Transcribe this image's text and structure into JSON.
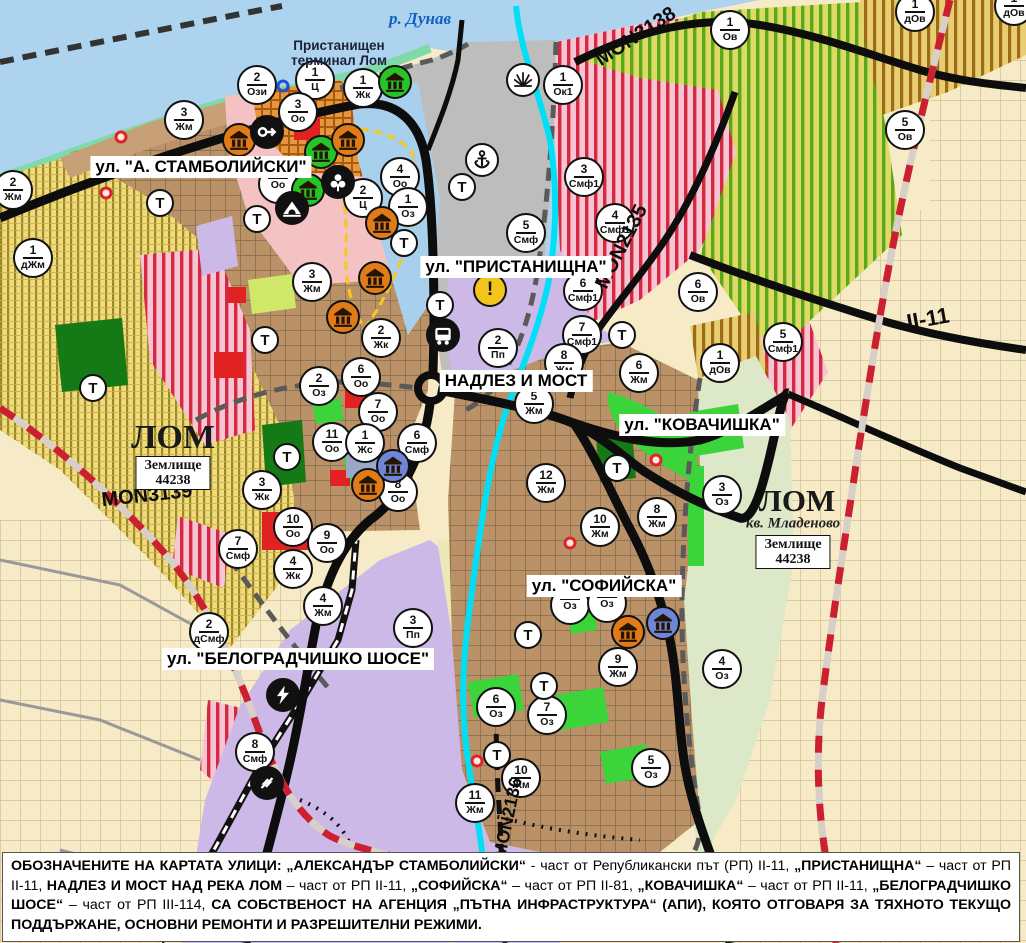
{
  "map": {
    "colors": {
      "water": "#aed3ee",
      "river_highlight": "#00dff5",
      "shore": "#7fd9a8",
      "port_gray": "#bdbdbd",
      "urban_brown": "#bb9268",
      "purple_zone": "#ccb9e8",
      "farm_yellow": "#f2dd7e",
      "mixed_pink": "#f6c4d2",
      "stripe_red": "#d42940",
      "vineyard_green": "#58a81c",
      "park_green": "#3bd43b",
      "dark_green": "#157a15",
      "road_black": "#0d0d0d",
      "boundary_red": "#cc2030",
      "warning_yellow": "#f2c41c",
      "monument_orange": "#e07b18",
      "monument_green": "#27c427",
      "monument_blue": "#6f86d6"
    },
    "place_labels": {
      "river": "р. Дунав",
      "port_terminal": "Пристанищен\nтерминал Лом",
      "city_west": "ЛОМ",
      "city_east": "ЛОМ",
      "quarter_east": "кв. Младеново",
      "land_box_line1": "Землище",
      "land_box_line2": "44238"
    },
    "street_labels": [
      {
        "x": 201,
        "y": 167,
        "text": "ул. \"А. СТАМБОЛИЙСКИ\""
      },
      {
        "x": 516,
        "y": 267,
        "text": "ул. \"ПРИСТАНИЩНА\""
      },
      {
        "x": 516,
        "y": 381,
        "text": "НАДЛЕЗ И МОСТ"
      },
      {
        "x": 702,
        "y": 425,
        "text": "ул. \"КОВАЧИШКА\""
      },
      {
        "x": 604,
        "y": 586,
        "text": "ул. \"СОФИЙСКА\""
      },
      {
        "x": 298,
        "y": 659,
        "text": "ул. \"БЕЛОГРАДЧИШКО ШОСЕ\""
      }
    ],
    "road_labels": [
      {
        "x": 147,
        "y": 496,
        "text": "MON3139",
        "rot": -6,
        "size": 20
      },
      {
        "x": 636,
        "y": 37,
        "text": "MON3138",
        "rot": -33,
        "size": 20
      },
      {
        "x": 622,
        "y": 247,
        "text": "MON2135",
        "rot": -63,
        "size": 20
      },
      {
        "x": 508,
        "y": 818,
        "text": "MON2136",
        "rot": -78,
        "size": 18
      },
      {
        "x": 928,
        "y": 319,
        "text": "II-11",
        "rot": -10,
        "size": 22
      }
    ],
    "area_boxes": [
      {
        "x": 173,
        "y": 473
      },
      {
        "x": 793,
        "y": 552
      }
    ],
    "zone_markers": [
      {
        "x": 315,
        "y": 80,
        "n": "1",
        "c": "Ц"
      },
      {
        "x": 363,
        "y": 88,
        "n": "1",
        "c": "Жк"
      },
      {
        "x": 257,
        "y": 85,
        "n": "2",
        "c": "Ози"
      },
      {
        "x": 298,
        "y": 112,
        "n": "3",
        "c": "Оо"
      },
      {
        "x": 184,
        "y": 120,
        "n": "3",
        "c": "Жм"
      },
      {
        "x": 13,
        "y": 190,
        "n": "2",
        "c": "Жм"
      },
      {
        "x": 33,
        "y": 258,
        "n": "1",
        "c": "дЖм"
      },
      {
        "x": 278,
        "y": 184,
        "n": "",
        "c": "Оо"
      },
      {
        "x": 400,
        "y": 177,
        "n": "4",
        "c": "Оо"
      },
      {
        "x": 363,
        "y": 198,
        "n": "2",
        "c": "Ц"
      },
      {
        "x": 408,
        "y": 207,
        "n": "1",
        "c": "Оз"
      },
      {
        "x": 563,
        "y": 85,
        "n": "1",
        "c": "Ок1"
      },
      {
        "x": 584,
        "y": 177,
        "n": "3",
        "c": "Смф1"
      },
      {
        "x": 526,
        "y": 233,
        "n": "5",
        "c": "Смф"
      },
      {
        "x": 615,
        "y": 223,
        "n": "4",
        "c": "Смф1"
      },
      {
        "x": 583,
        "y": 291,
        "n": "6",
        "c": "Смф1"
      },
      {
        "x": 698,
        "y": 292,
        "n": "6",
        "c": "Ов"
      },
      {
        "x": 720,
        "y": 363,
        "n": "1",
        "c": "дОв"
      },
      {
        "x": 783,
        "y": 342,
        "n": "5",
        "c": "Смф1"
      },
      {
        "x": 730,
        "y": 30,
        "n": "1",
        "c": "Ов"
      },
      {
        "x": 905,
        "y": 130,
        "n": "5",
        "c": "Ов"
      },
      {
        "x": 915,
        "y": 12,
        "n": "1",
        "c": "дОв"
      },
      {
        "x": 1014,
        "y": 6,
        "n": "1",
        "c": "дОв"
      },
      {
        "x": 312,
        "y": 282,
        "n": "3",
        "c": "Жм"
      },
      {
        "x": 381,
        "y": 338,
        "n": "2",
        "c": "Жк"
      },
      {
        "x": 361,
        "y": 377,
        "n": "6",
        "c": "Оо"
      },
      {
        "x": 319,
        "y": 386,
        "n": "2",
        "c": "Оз"
      },
      {
        "x": 378,
        "y": 412,
        "n": "7",
        "c": "Оо"
      },
      {
        "x": 332,
        "y": 442,
        "n": "11",
        "c": "Оо"
      },
      {
        "x": 365,
        "y": 443,
        "n": "1",
        "c": "Жс"
      },
      {
        "x": 417,
        "y": 443,
        "n": "6",
        "c": "Смф"
      },
      {
        "x": 398,
        "y": 492,
        "n": "8",
        "c": "Оо"
      },
      {
        "x": 498,
        "y": 348,
        "n": "2",
        "c": "Пп"
      },
      {
        "x": 582,
        "y": 335,
        "n": "7",
        "c": "Смф1"
      },
      {
        "x": 564,
        "y": 363,
        "n": "8",
        "c": "Жм"
      },
      {
        "x": 639,
        "y": 373,
        "n": "6",
        "c": "Жм"
      },
      {
        "x": 534,
        "y": 404,
        "n": "5",
        "c": "Жм"
      },
      {
        "x": 546,
        "y": 483,
        "n": "12",
        "c": "Жм"
      },
      {
        "x": 262,
        "y": 490,
        "n": "3",
        "c": "Жк"
      },
      {
        "x": 293,
        "y": 527,
        "n": "10",
        "c": "Оо"
      },
      {
        "x": 327,
        "y": 543,
        "n": "9",
        "c": "Оо"
      },
      {
        "x": 238,
        "y": 549,
        "n": "7",
        "c": "Смф"
      },
      {
        "x": 293,
        "y": 569,
        "n": "4",
        "c": "Жк"
      },
      {
        "x": 323,
        "y": 606,
        "n": "4",
        "c": "Жм"
      },
      {
        "x": 209,
        "y": 632,
        "n": "2",
        "c": "дСмф"
      },
      {
        "x": 413,
        "y": 628,
        "n": "3",
        "c": "Пп"
      },
      {
        "x": 255,
        "y": 752,
        "n": "8",
        "c": "Смф"
      },
      {
        "x": 722,
        "y": 495,
        "n": "3",
        "c": "Оз"
      },
      {
        "x": 657,
        "y": 517,
        "n": "8",
        "c": "Жм"
      },
      {
        "x": 600,
        "y": 527,
        "n": "10",
        "c": "Жм"
      },
      {
        "x": 570,
        "y": 605,
        "n": "",
        "c": "Оз"
      },
      {
        "x": 607,
        "y": 603,
        "n": "",
        "c": "Оз"
      },
      {
        "x": 618,
        "y": 667,
        "n": "9",
        "c": "Жм"
      },
      {
        "x": 722,
        "y": 669,
        "n": "4",
        "c": "Оз"
      },
      {
        "x": 496,
        "y": 707,
        "n": "6",
        "c": "Оз"
      },
      {
        "x": 547,
        "y": 715,
        "n": "7",
        "c": "Оз"
      },
      {
        "x": 521,
        "y": 778,
        "n": "10",
        "c": "Жм"
      },
      {
        "x": 651,
        "y": 768,
        "n": "5",
        "c": "Оз"
      },
      {
        "x": 475,
        "y": 803,
        "n": "11",
        "c": "Жм"
      }
    ],
    "t_markers": [
      {
        "x": 160,
        "y": 203
      },
      {
        "x": 257,
        "y": 219
      },
      {
        "x": 404,
        "y": 243
      },
      {
        "x": 440,
        "y": 305
      },
      {
        "x": 462,
        "y": 187
      },
      {
        "x": 265,
        "y": 340
      },
      {
        "x": 93,
        "y": 388
      },
      {
        "x": 622,
        "y": 335
      },
      {
        "x": 287,
        "y": 457
      },
      {
        "x": 617,
        "y": 468
      },
      {
        "x": 528,
        "y": 635
      },
      {
        "x": 544,
        "y": 686
      },
      {
        "x": 497,
        "y": 755
      }
    ],
    "t_letter": "Т",
    "icon_markers": [
      {
        "x": 395,
        "y": 82,
        "kind": "monument",
        "bg": "green"
      },
      {
        "x": 523,
        "y": 80,
        "kind": "harbor",
        "bg": "white"
      },
      {
        "x": 482,
        "y": 160,
        "kind": "anchor",
        "bg": "white"
      },
      {
        "x": 239,
        "y": 140,
        "kind": "monument",
        "bg": "orange"
      },
      {
        "x": 267,
        "y": 132,
        "kind": "key",
        "bg": "black"
      },
      {
        "x": 321,
        "y": 152,
        "kind": "monument",
        "bg": "green"
      },
      {
        "x": 308,
        "y": 190,
        "kind": "monument",
        "bg": "green"
      },
      {
        "x": 338,
        "y": 182,
        "kind": "trefoil",
        "bg": "black"
      },
      {
        "x": 292,
        "y": 208,
        "kind": "tunnel",
        "bg": "black"
      },
      {
        "x": 348,
        "y": 140,
        "kind": "monument",
        "bg": "orange"
      },
      {
        "x": 382,
        "y": 223,
        "kind": "monument",
        "bg": "orange"
      },
      {
        "x": 375,
        "y": 278,
        "kind": "monument",
        "bg": "orange"
      },
      {
        "x": 343,
        "y": 317,
        "kind": "monument",
        "bg": "orange"
      },
      {
        "x": 368,
        "y": 485,
        "kind": "monument",
        "bg": "orange"
      },
      {
        "x": 393,
        "y": 466,
        "kind": "monument",
        "bg": "blue"
      },
      {
        "x": 443,
        "y": 335,
        "kind": "bus",
        "bg": "black"
      },
      {
        "x": 490,
        "y": 290,
        "kind": "warning",
        "bg": "yellow"
      },
      {
        "x": 628,
        "y": 632,
        "kind": "monument",
        "bg": "orange"
      },
      {
        "x": 663,
        "y": 623,
        "kind": "monument",
        "bg": "blue"
      },
      {
        "x": 283,
        "y": 695,
        "kind": "lightning",
        "bg": "black"
      },
      {
        "x": 267,
        "y": 783,
        "kind": "railnode",
        "bg": "black"
      }
    ],
    "dot_markers": [
      {
        "x": 121,
        "y": 137
      },
      {
        "x": 106,
        "y": 193
      },
      {
        "x": 656,
        "y": 460
      },
      {
        "x": 477,
        "y": 761
      },
      {
        "x": 570,
        "y": 543
      }
    ],
    "ring_markers": [
      {
        "x": 283,
        "y": 86
      }
    ]
  },
  "legend": {
    "segments": [
      {
        "text": "ОБОЗНАЧЕНИТЕ НА КАРТАТА УЛИЦИ: „АЛЕКСАНДЪР СТАМБОЛИЙСКИ“",
        "bold": true
      },
      {
        "text": " - част от Републикански път (РП) II-11, ",
        "bold": false
      },
      {
        "text": "„ПРИСТАНИЩНА“",
        "bold": true
      },
      {
        "text": " – част от РП II-11, ",
        "bold": false
      },
      {
        "text": "НАДЛЕЗ И МОСТ НАД РЕКА ЛОМ",
        "bold": true
      },
      {
        "text": " – част от РП II-11, ",
        "bold": false
      },
      {
        "text": "„СОФИЙСКА“",
        "bold": true
      },
      {
        "text": " – част от РП II-81, ",
        "bold": false
      },
      {
        "text": "„КОВАЧИШКА“",
        "bold": true
      },
      {
        "text": " – част от РП II-11, ",
        "bold": false
      },
      {
        "text": "„БЕЛОГРАДЧИШКО ШОСЕ“",
        "bold": true
      },
      {
        "text": " – част от РП III-114, ",
        "bold": false
      },
      {
        "text": "СА СОБСТВЕНОСТ НА АГЕНЦИЯ „ПЪТНА ИНФРАСТРУКТУРА“ (АПИ), КОЯТО ОТГОВАРЯ ЗА ТЯХНОТО ТЕКУЩО ПОДДЪРЖАНЕ, ОСНОВНИ РЕМОНТИ И РАЗРЕШИТЕЛНИ РЕЖИМИ.",
        "bold": true
      }
    ]
  }
}
